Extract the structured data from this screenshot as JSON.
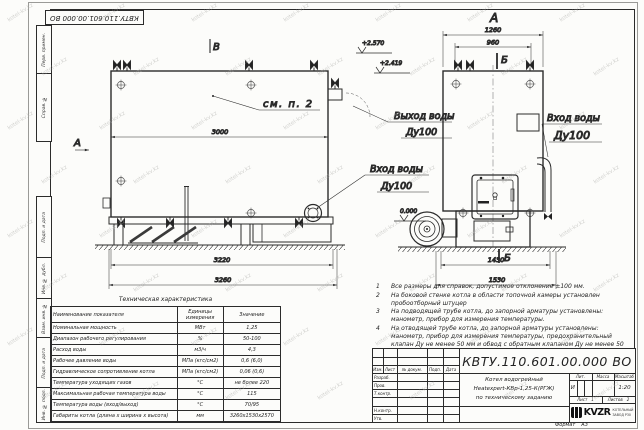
{
  "watermark": "kotel-kv.kz",
  "stamp_top": "КВТУ.110.601.00.000 ВО",
  "margin": {
    "perv_primen": "Перв. примен.",
    "sprav_no": "Справ. №",
    "podp_data_1": "Подп. и дата",
    "inv_dubl": "Инв. № дубл.",
    "vzam_inv": "Взам. инв. №",
    "podp_data_2": "Подп. и дата",
    "inv_podl": "Инв. № подл."
  },
  "side_view": {
    "view_mark_top": "В",
    "section_mark_left": "А",
    "callout": "см. п. 2",
    "dim_body": "3000",
    "dim_frame": "3220",
    "dim_total": "3260",
    "elev_upper": "+2.570",
    "elev_lower": "+2.419",
    "outlet_line1": "Выход воды",
    "outlet_line2": "Ду100",
    "inlet_line1": "Вход воды",
    "inlet_line2": "Ду100"
  },
  "front_view": {
    "view_title": "А",
    "dim_top_outer": "1260",
    "dim_top_inner": "960",
    "section_top": "Б",
    "section_bottom": "Б",
    "elev_zero": "0.000",
    "dim_bottom_inner": "1430",
    "dim_bottom_outer": "1530",
    "inlet_line1": "Вход воды",
    "inlet_line2": "Ду100"
  },
  "tech_table": {
    "title": "Техническая характеристика",
    "col_name": "Наименование показателя",
    "col_units": "Единицы измерения",
    "col_value": "Значение",
    "rows": [
      {
        "name": "Номинальная мощность",
        "units": "МВт",
        "value": "1,25"
      },
      {
        "name": "Диапазон рабочего регулирования",
        "units": "%",
        "value": "50-100"
      },
      {
        "name": "Расход воды",
        "units": "м3/ч",
        "value": "4,3"
      },
      {
        "name": "Рабочее давление воды",
        "units": "МПа (кгс/см2)",
        "value": "0,6 (6,0)"
      },
      {
        "name": "Гидравлическое сопротивление котла",
        "units": "МПа (кгс/см2)",
        "value": "0,06 (0,6)"
      },
      {
        "name": "Температура уходящих газов",
        "units": "°С",
        "value": "не более 220"
      },
      {
        "name": "Максимальная рабочая температура воды",
        "units": "°С",
        "value": "115"
      },
      {
        "name": "Температура воды (вход/выход)",
        "units": "°С",
        "value": "70/95"
      },
      {
        "name": "Габариты котла (длина х ширина х высота)",
        "units": "мм",
        "value": "3260х1530х2570"
      }
    ]
  },
  "notes": {
    "n1": {
      "num": "1",
      "text": "Все размеры для справок, допустимое отклонение ±100 мм."
    },
    "n2": {
      "num": "2",
      "text": "На боковой стенке котла в области топочной камеры установлен пробоотборный штуцер"
    },
    "n3": {
      "num": "3",
      "text": "На подводящей трубе котла, до запорной арматуры установлены: манометр, прибор для измерения температуры."
    },
    "n4": {
      "num": "4",
      "text": "На отводящей трубе котла, до запорной арматуры установлены: манометр, прибор для измерения температуры, предохранительный клапан Ду не менее 50 мм и обвод с обратным клапаном Ду не менее 50 мм."
    }
  },
  "title_block": {
    "doc_number": "КВТУ.110.601.00.000  ВО",
    "name_line1": "Котел водогрейный",
    "name_line2": "Heatexpert-КВр-1,25-К(РГЖ)",
    "name_line3": "по техническому заданию",
    "header_izm": "Изм.",
    "header_list": "Лист",
    "header_doc": "№ докум.",
    "header_podp": "Подп.",
    "header_data": "Дата",
    "row_razrab": "Разраб.",
    "row_prov": "Пров.",
    "row_tkontr": "Т.контр.",
    "row_nkontr": "Н.контр.",
    "row_utv": "Утв.",
    "lit_label": "Лит.",
    "lit_value": "И",
    "massa_label": "Масса",
    "masshtab_label": "Масштаб",
    "masshtab_value": "1:20",
    "list_label": "Лист",
    "list_value": "1",
    "listov_label": "Листов",
    "listov_value": "2",
    "logo_text": "KVZR",
    "logo_sub1": "КОТЕЛЬНЫЙ",
    "logo_sub2": "ЗАВОД Р30",
    "format_label": "Формат",
    "format_value": "А3"
  }
}
